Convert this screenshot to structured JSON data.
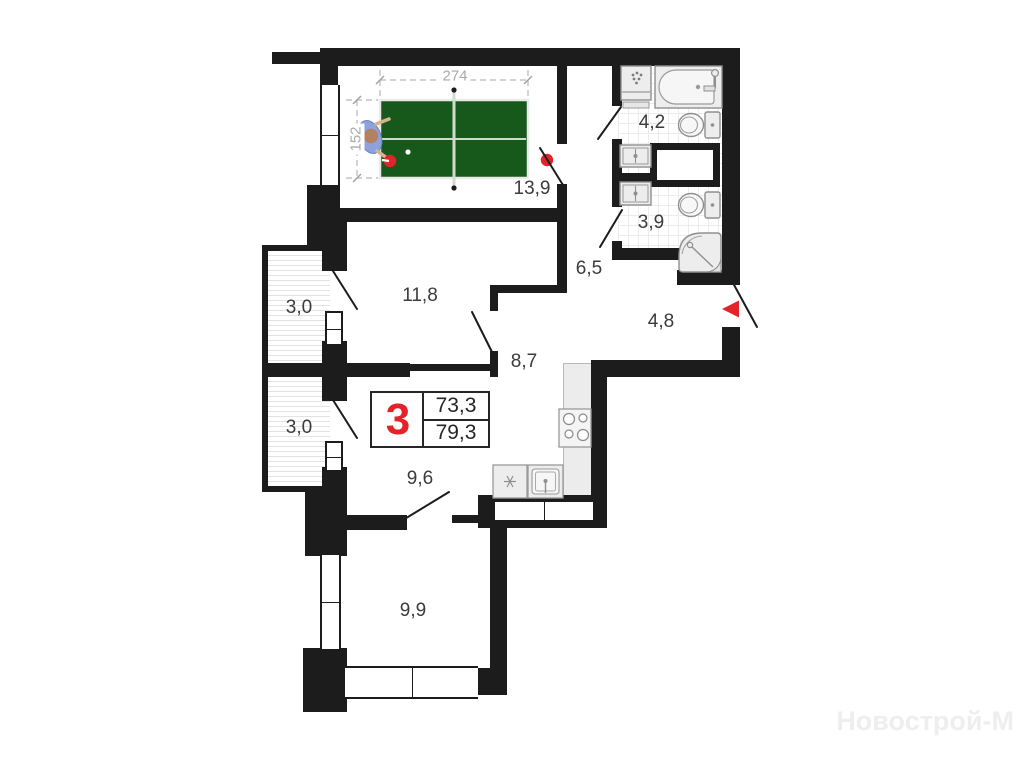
{
  "info_box": {
    "rooms_count": "3",
    "area_1": "73,3",
    "area_2": "79,3"
  },
  "room_labels": {
    "living": "13,9",
    "bedroom": "11,8",
    "room_mid": "9,6",
    "room_bottom": "9,9",
    "hall": "8,7",
    "corridor": "6,5",
    "hallway": "4,8",
    "bathroom": "4,2",
    "wc": "3,9",
    "balcony_top": "3,0",
    "balcony_bottom": "3,0"
  },
  "table_dims": {
    "length": "274",
    "width": "152"
  },
  "watermark": "Новострой-М",
  "colors": {
    "wall": "#1c1c1c",
    "accent_red": "#e32229",
    "table_green": "#17591b"
  }
}
